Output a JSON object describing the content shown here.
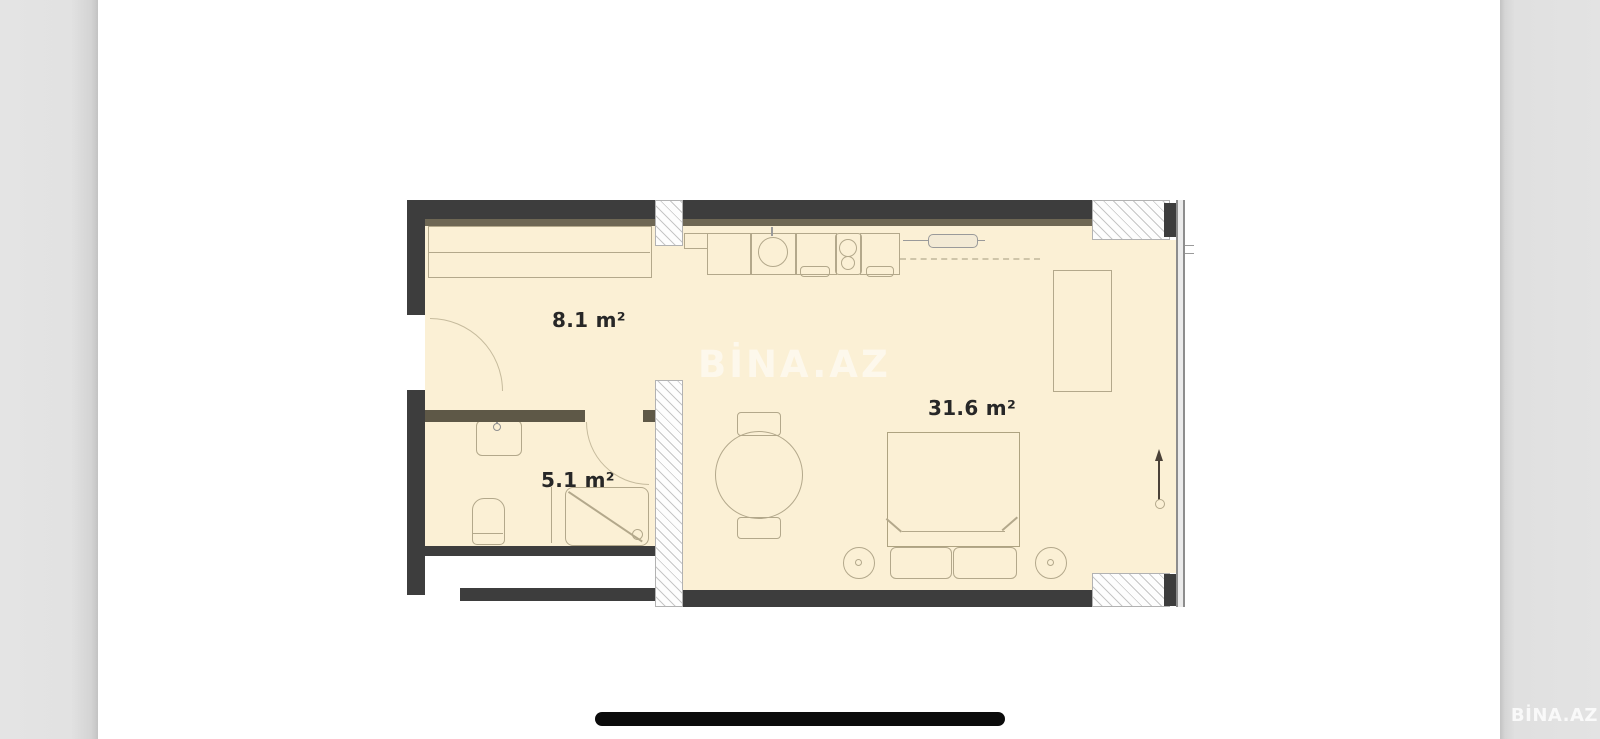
{
  "viewer": {
    "watermark_center": "BİNA.AZ",
    "watermark_corner": "BİNA.AZ"
  },
  "floorplan": {
    "rooms": [
      {
        "id": "hallway",
        "area_label": "8.1 m²"
      },
      {
        "id": "bathroom",
        "area_label": "5.1 m²"
      },
      {
        "id": "living-room",
        "area_label": "31.6 m²"
      }
    ],
    "furniture": {
      "hallway": [
        "closet",
        "entrance-door"
      ],
      "bathroom": [
        "washbasin",
        "toilet",
        "shower",
        "bathroom-door"
      ],
      "living-room": [
        "kitchen-counter",
        "kitchen-sink",
        "stove",
        "radiator",
        "wardrobe",
        "dining-table",
        "chairs",
        "double-bed",
        "pillows",
        "nightstands"
      ]
    },
    "colors": {
      "floor": "#fbf0d5",
      "wall": "#3d3d3d",
      "wall_shadow": "#6e6754",
      "partition": "#5e5847",
      "furniture_line": "#b3a88b"
    }
  }
}
